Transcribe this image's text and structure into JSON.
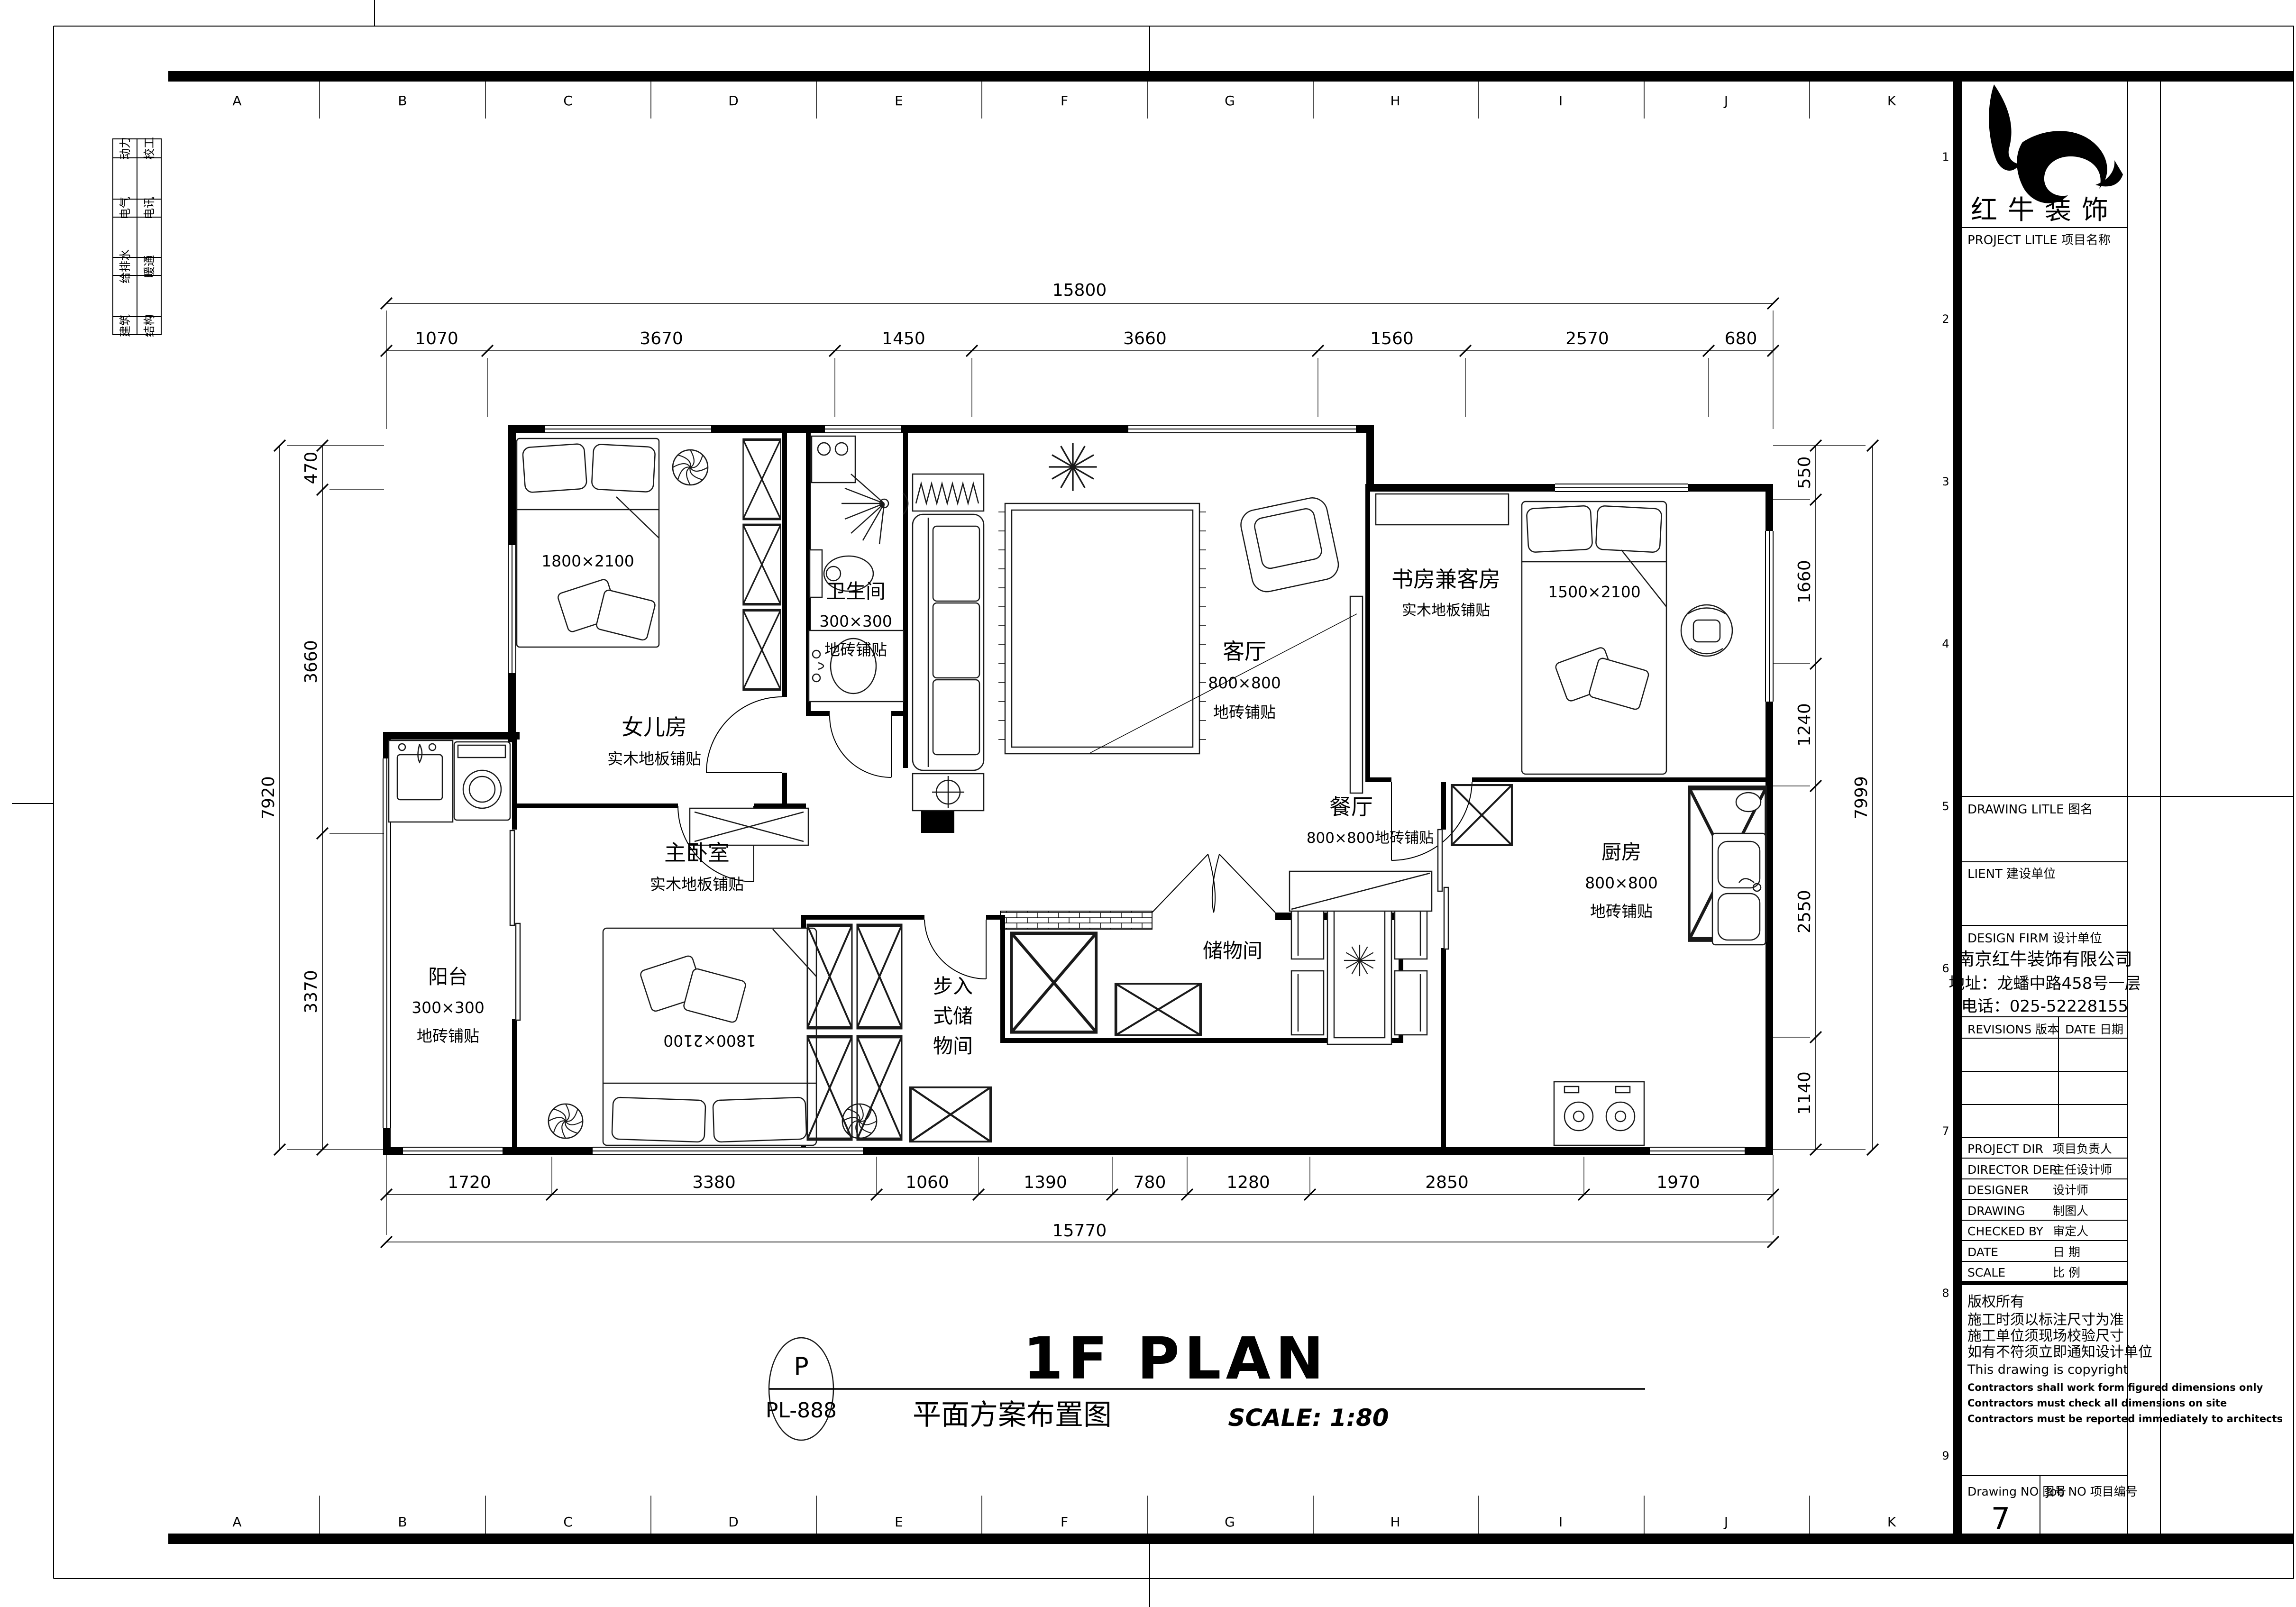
{
  "sheet": {
    "grid_letters": [
      "A",
      "B",
      "C",
      "D",
      "E",
      "F",
      "G",
      "H",
      "I",
      "J",
      "K"
    ],
    "fold_numbers": [
      "1",
      "2",
      "3",
      "4",
      "5",
      "6",
      "7",
      "8",
      "9"
    ],
    "disciplines": [
      [
        "动力",
        "校工"
      ],
      [
        "电气",
        "电讯"
      ],
      [
        "给排水",
        "暖通"
      ],
      [
        "建筑",
        "结构"
      ]
    ]
  },
  "plan": {
    "rooms": {
      "daughter": {
        "name": "女儿房",
        "floor": "实木地板铺贴",
        "bed": "1800×2100"
      },
      "bath": {
        "name": "卫生间",
        "tile": "300×300",
        "tile2": "地砖铺贴"
      },
      "living": {
        "name": "客厅",
        "tile": "800×800",
        "tile2": "地砖铺贴"
      },
      "study": {
        "name": "书房兼客房",
        "floor": "实木地板铺贴",
        "bed": "1500×2100"
      },
      "dining": {
        "name": "餐厅",
        "tile": "800×800地砖铺贴"
      },
      "kitchen": {
        "name": "厨房",
        "tile": "800×800",
        "tile2": "地砖铺贴"
      },
      "master": {
        "name": "主卧室",
        "floor": "实木地板铺贴",
        "bed": "1800×2100"
      },
      "balcony": {
        "name": "阳台",
        "tile": "300×300",
        "tile2": "地砖铺贴"
      },
      "walkin": {
        "rows": [
          "步入",
          "式储",
          "物间"
        ]
      },
      "storage": {
        "name": "储物间"
      }
    },
    "dims": {
      "top_total": "15800",
      "top": [
        "1070",
        "3670",
        "1450",
        "3660",
        "1560",
        "2570",
        "680"
      ],
      "bottom": [
        "1720",
        "3380",
        "1060",
        "1390",
        "780",
        "1280",
        "2850",
        "1970"
      ],
      "bottom_total": "15770",
      "left": [
        "470",
        "3660",
        "3370"
      ],
      "left_total": "7920",
      "right": [
        "550",
        "1660",
        "1240",
        "2550",
        "1140"
      ],
      "right_total": "7999"
    }
  },
  "titlebar": {
    "bubble_top": "P",
    "bubble_code": "PL-888",
    "title_en": "1F PLAN",
    "title_cn": "平面方案布置图",
    "scale": "SCALE: 1:80"
  },
  "titleblock": {
    "brand": "红牛装饰",
    "project_title": "PROJECT LITLE   项目名称",
    "drawing_title": "DRAWING LITLE   图名",
    "client": "LIENT   建设单位",
    "design_firm": "DESIGN FIRM   设计单位",
    "firm_name": "南京红牛装饰有限公司",
    "firm_addr": "地址：龙蟠中路458号一层",
    "firm_tel": "电话：025-52228155",
    "revisions": "REVISIONS  版本",
    "date_col": "DATE 日期",
    "rows": [
      {
        "en": "PROJECT DIR",
        "cn": "项目负责人"
      },
      {
        "en": "DIRECTOR DER",
        "cn": "主任设计师"
      },
      {
        "en": "DESIGNER",
        "cn": "设计师"
      },
      {
        "en": "DRAWING",
        "cn": "制图人"
      },
      {
        "en": "CHECKED BY",
        "cn": "审定人"
      },
      {
        "en": "DATE",
        "cn": "日  期"
      },
      {
        "en": "SCALE",
        "cn": "比  例"
      }
    ],
    "notes": [
      "版权所有",
      "施工时须以标注尺寸为准",
      "施工单位须现场校验尺寸",
      "如有不符须立即通知设计单位",
      "This drawing is copyright",
      "Contractors shall work form figured dimensions only",
      "Contractors must check all dimensions on site",
      "Contractors must be reported immediately to architects"
    ],
    "drawing_no_label": "Drawing NO  图号",
    "drawing_no": "7",
    "job_no_label": "Job NO  项目编号"
  }
}
